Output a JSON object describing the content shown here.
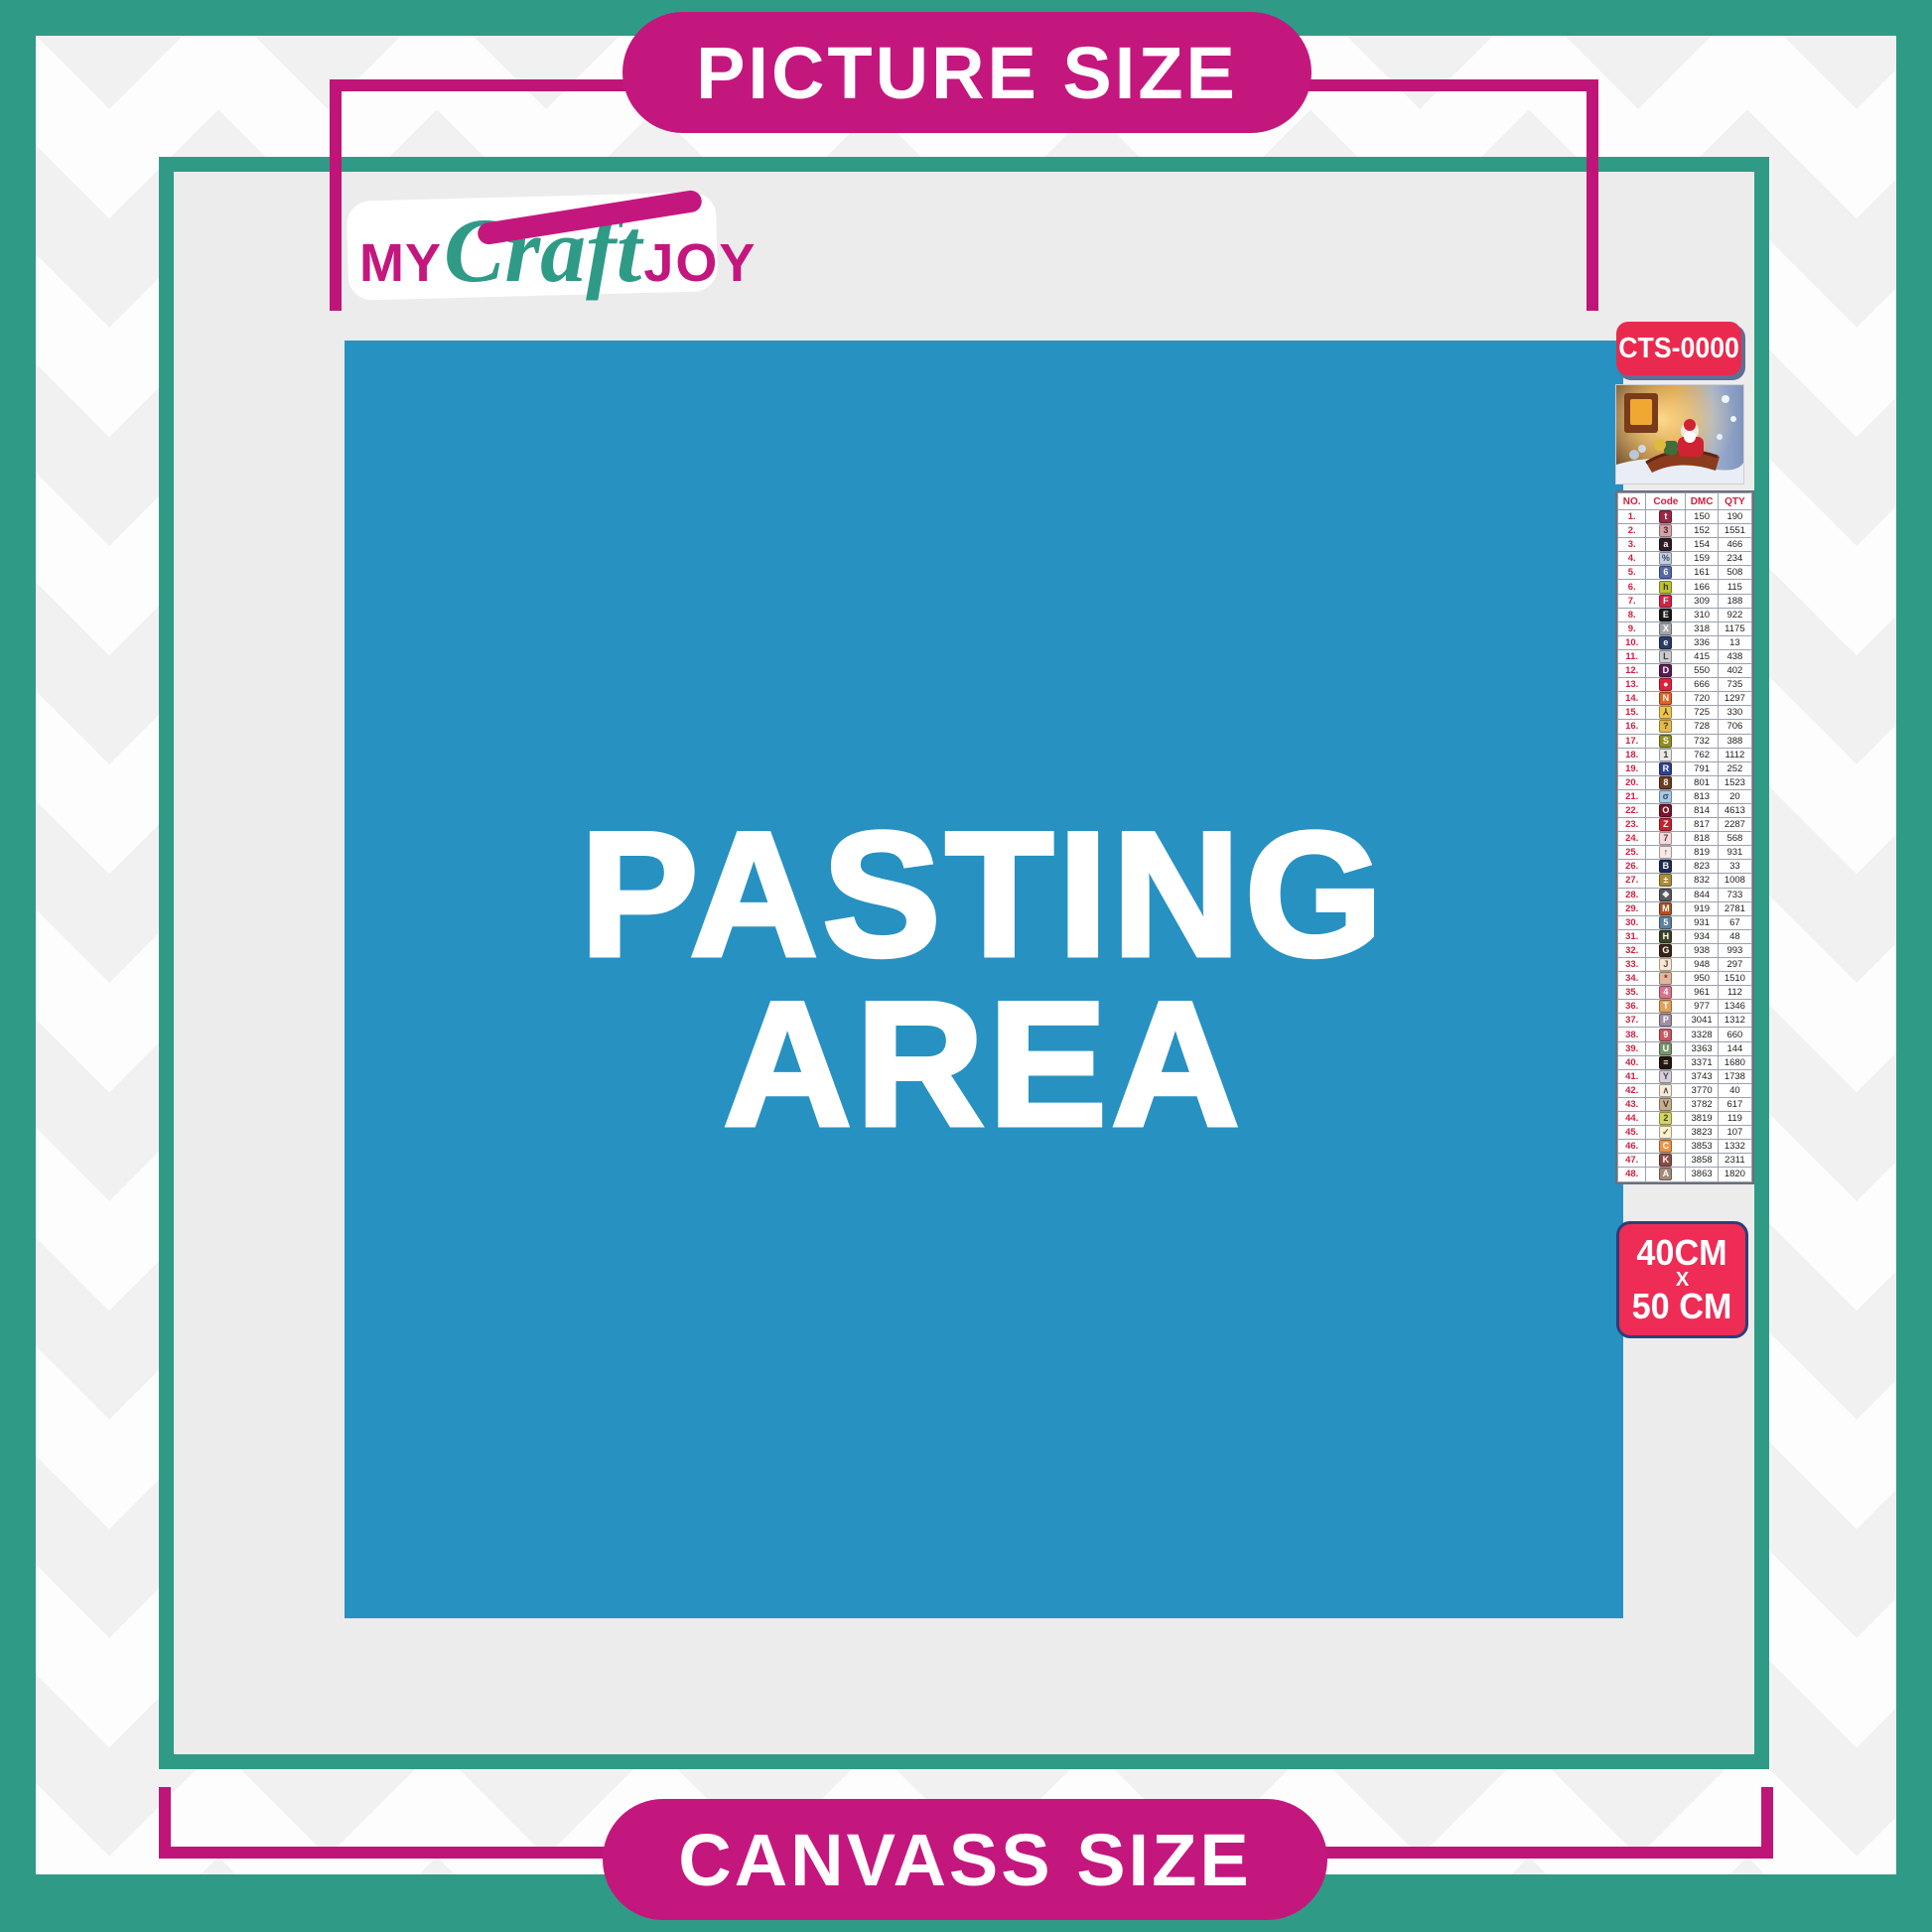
{
  "colors": {
    "teal": "#2f9b86",
    "magenta": "#c4177e",
    "blue": "#2791c2",
    "badge_red": "#e92a4e",
    "badge_border": "#2b3f7a",
    "canvas_gray": "#ececec"
  },
  "header": {
    "title": "PICTURE SIZE"
  },
  "footer": {
    "title": "CANVASS SIZE"
  },
  "logo": {
    "my": "MY",
    "craft": "Craft",
    "joy": "JOY"
  },
  "pasting_area": {
    "line1": "PASTING",
    "line2": "AREA"
  },
  "product": {
    "code": "CTS-0000",
    "preview_alt": "christmas-santa-sleigh-scene",
    "size_line1": "40CM",
    "size_line2": "X",
    "size_line3": "50 CM"
  },
  "legend": {
    "columns": [
      "NO.",
      "Code",
      "DMC",
      "QTY"
    ],
    "rows": [
      {
        "no": "1.",
        "symbol": "t",
        "dmc": "150",
        "qty": "190",
        "chip_bg": "#9b2743",
        "chip_fg": "#ffffff"
      },
      {
        "no": "2.",
        "symbol": "3",
        "dmc": "152",
        "qty": "1551",
        "chip_bg": "#d4a2a8",
        "chip_fg": "#4a262e"
      },
      {
        "no": "3.",
        "symbol": "a",
        "dmc": "154",
        "qty": "466",
        "chip_bg": "#2e1c24",
        "chip_fg": "#ffffff"
      },
      {
        "no": "4.",
        "symbol": "%",
        "dmc": "159",
        "qty": "234",
        "chip_bg": "#c5cfe1",
        "chip_fg": "#3c4c68"
      },
      {
        "no": "5.",
        "symbol": "6",
        "dmc": "161",
        "qty": "508",
        "chip_bg": "#5568a9",
        "chip_fg": "#ffffff"
      },
      {
        "no": "6.",
        "symbol": "h",
        "dmc": "166",
        "qty": "115",
        "chip_bg": "#bcc230",
        "chip_fg": "#3a3a0c"
      },
      {
        "no": "7.",
        "symbol": "F",
        "dmc": "309",
        "qty": "188",
        "chip_bg": "#d02446",
        "chip_fg": "#ffffff"
      },
      {
        "no": "8.",
        "symbol": "E",
        "dmc": "310",
        "qty": "922",
        "chip_bg": "#191919",
        "chip_fg": "#ffffff"
      },
      {
        "no": "9.",
        "symbol": "X",
        "dmc": "318",
        "qty": "1175",
        "chip_bg": "#a2a4aa",
        "chip_fg": "#ffffff"
      },
      {
        "no": "10.",
        "symbol": "e",
        "dmc": "336",
        "qty": "13",
        "chip_bg": "#273c68",
        "chip_fg": "#ffffff"
      },
      {
        "no": "11.",
        "symbol": "L",
        "dmc": "415",
        "qty": "438",
        "chip_bg": "#c9cbce",
        "chip_fg": "#40414b"
      },
      {
        "no": "12.",
        "symbol": "D",
        "dmc": "550",
        "qty": "402",
        "chip_bg": "#5c1b54",
        "chip_fg": "#ffffff"
      },
      {
        "no": "13.",
        "symbol": "●",
        "dmc": "666",
        "qty": "735",
        "chip_bg": "#e12139",
        "chip_fg": "#ffffff"
      },
      {
        "no": "14.",
        "symbol": "N",
        "dmc": "720",
        "qty": "1297",
        "chip_bg": "#e16222",
        "chip_fg": "#ffffff"
      },
      {
        "no": "15.",
        "symbol": "⅄",
        "dmc": "725",
        "qty": "330",
        "chip_bg": "#f3c34b",
        "chip_fg": "#4c3b08"
      },
      {
        "no": "16.",
        "symbol": "?",
        "dmc": "728",
        "qty": "706",
        "chip_bg": "#e4b950",
        "chip_fg": "#4a3606"
      },
      {
        "no": "17.",
        "symbol": "S",
        "dmc": "732",
        "qty": "388",
        "chip_bg": "#908d21",
        "chip_fg": "#ffffff"
      },
      {
        "no": "18.",
        "symbol": "1",
        "dmc": "762",
        "qty": "1112",
        "chip_bg": "#eae8e7",
        "chip_fg": "#3b3b3b"
      },
      {
        "no": "19.",
        "symbol": "R",
        "dmc": "791",
        "qty": "252",
        "chip_bg": "#32418f",
        "chip_fg": "#ffffff"
      },
      {
        "no": "20.",
        "symbol": "8",
        "dmc": "801",
        "qty": "1523",
        "chip_bg": "#6c3b21",
        "chip_fg": "#ffffff"
      },
      {
        "no": "21.",
        "symbol": "σ",
        "dmc": "813",
        "qty": "20",
        "chip_bg": "#a7c7e3",
        "chip_fg": "#2b4b6b"
      },
      {
        "no": "22.",
        "symbol": "O",
        "dmc": "814",
        "qty": "4613",
        "chip_bg": "#7d1329",
        "chip_fg": "#ffffff"
      },
      {
        "no": "23.",
        "symbol": "Z",
        "dmc": "817",
        "qty": "2287",
        "chip_bg": "#c62131",
        "chip_fg": "#ffffff"
      },
      {
        "no": "24.",
        "symbol": "7",
        "dmc": "818",
        "qty": "568",
        "chip_bg": "#f7d9dd",
        "chip_fg": "#5b3b41"
      },
      {
        "no": "25.",
        "symbol": "↑",
        "dmc": "819",
        "qty": "931",
        "chip_bg": "#f5e8e5",
        "chip_fg": "#4b4b4b"
      },
      {
        "no": "26.",
        "symbol": "B",
        "dmc": "823",
        "qty": "33",
        "chip_bg": "#1f2b57",
        "chip_fg": "#ffffff"
      },
      {
        "no": "27.",
        "symbol": "±",
        "dmc": "832",
        "qty": "1008",
        "chip_bg": "#a98a3b",
        "chip_fg": "#fffbe9"
      },
      {
        "no": "28.",
        "symbol": "❖",
        "dmc": "844",
        "qty": "733",
        "chip_bg": "#56575b",
        "chip_fg": "#f1f1f1"
      },
      {
        "no": "29.",
        "symbol": "M",
        "dmc": "919",
        "qty": "2781",
        "chip_bg": "#b15120",
        "chip_fg": "#ffffff"
      },
      {
        "no": "30.",
        "symbol": "5",
        "dmc": "931",
        "qty": "67",
        "chip_bg": "#5f809d",
        "chip_fg": "#ffffff"
      },
      {
        "no": "31.",
        "symbol": "H",
        "dmc": "934",
        "qty": "48",
        "chip_bg": "#3a4320",
        "chip_fg": "#ffffff"
      },
      {
        "no": "32.",
        "symbol": "G",
        "dmc": "938",
        "qty": "993",
        "chip_bg": "#3b2515",
        "chip_fg": "#ffffff"
      },
      {
        "no": "33.",
        "symbol": "J",
        "dmc": "948",
        "qty": "297",
        "chip_bg": "#fae6d5",
        "chip_fg": "#6b4b36"
      },
      {
        "no": "34.",
        "symbol": "*",
        "dmc": "950",
        "qty": "1510",
        "chip_bg": "#e3b59b",
        "chip_fg": "#5b3b2b"
      },
      {
        "no": "35.",
        "symbol": "4",
        "dmc": "961",
        "qty": "112",
        "chip_bg": "#d9748f",
        "chip_fg": "#ffffff"
      },
      {
        "no": "36.",
        "symbol": "T",
        "dmc": "977",
        "qty": "1346",
        "chip_bg": "#dea258",
        "chip_fg": "#ffffff"
      },
      {
        "no": "37.",
        "symbol": "P",
        "dmc": "3041",
        "qty": "1312",
        "chip_bg": "#9f8ea5",
        "chip_fg": "#ffffff"
      },
      {
        "no": "38.",
        "symbol": "9",
        "dmc": "3328",
        "qty": "660",
        "chip_bg": "#ca575f",
        "chip_fg": "#ffffff"
      },
      {
        "no": "39.",
        "symbol": "U",
        "dmc": "3363",
        "qty": "144",
        "chip_bg": "#79956b",
        "chip_fg": "#ffffff"
      },
      {
        "no": "40.",
        "symbol": "≡",
        "dmc": "3371",
        "qty": "1680",
        "chip_bg": "#23160a",
        "chip_fg": "#f6f6f6"
      },
      {
        "no": "41.",
        "symbol": "Y",
        "dmc": "3743",
        "qty": "1738",
        "chip_bg": "#d5cdd9",
        "chip_fg": "#4b4553"
      },
      {
        "no": "42.",
        "symbol": "∧",
        "dmc": "3770",
        "qty": "40",
        "chip_bg": "#f8ebd9",
        "chip_fg": "#5b513d"
      },
      {
        "no": "43.",
        "symbol": "V",
        "dmc": "3782",
        "qty": "617",
        "chip_bg": "#c5ae8c",
        "chip_fg": "#463929"
      },
      {
        "no": "44.",
        "symbol": "2",
        "dmc": "3819",
        "qty": "119",
        "chip_bg": "#d4d464",
        "chip_fg": "#454510"
      },
      {
        "no": "45.",
        "symbol": "✓",
        "dmc": "3823",
        "qty": "107",
        "chip_bg": "#fbf1ce",
        "chip_fg": "#6b5b2b"
      },
      {
        "no": "46.",
        "symbol": "C",
        "dmc": "3853",
        "qty": "1332",
        "chip_bg": "#ed9347",
        "chip_fg": "#ffffff"
      },
      {
        "no": "47.",
        "symbol": "K",
        "dmc": "3858",
        "qty": "2311",
        "chip_bg": "#8e4b45",
        "chip_fg": "#ffffff"
      },
      {
        "no": "48.",
        "symbol": "A",
        "dmc": "3863",
        "qty": "1820",
        "chip_bg": "#a18b77",
        "chip_fg": "#ffffff"
      }
    ]
  }
}
